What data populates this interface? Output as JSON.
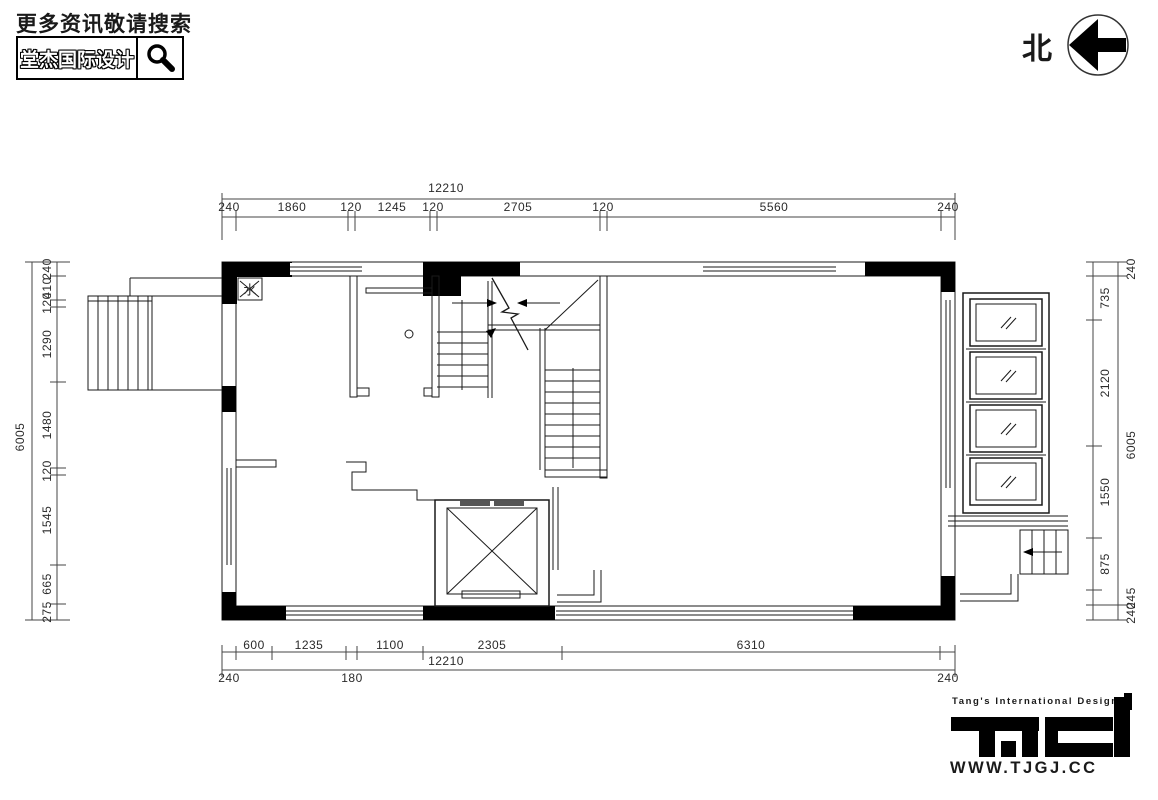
{
  "header": {
    "search_hint": "更多资讯敬请搜索",
    "brand": "堂杰国际设计"
  },
  "north": {
    "label": "北"
  },
  "plan": {
    "water_label": "水"
  },
  "dims": {
    "top": {
      "overall": "12210",
      "segments": [
        "240",
        "1860",
        "120",
        "1245",
        "120",
        "2705",
        "120",
        "5560",
        "240"
      ]
    },
    "bottom": {
      "segments": [
        "600",
        "1235",
        "1100",
        "2305",
        "6310"
      ],
      "overall": "12210",
      "below": [
        "240",
        "180",
        "240"
      ]
    },
    "left": {
      "overall": "6005",
      "segments": [
        "240",
        "410",
        "120",
        "1290",
        "1480",
        "120",
        "1545",
        "665",
        "275"
      ]
    },
    "right": {
      "inner": [
        "735",
        "2120",
        "1550",
        "875"
      ],
      "outer": [
        "240",
        "6005",
        "245",
        "240"
      ]
    }
  },
  "logo": {
    "tagline": "Tang's International Design",
    "url": "WWW.TJGJ.CC"
  },
  "colors": {
    "ink": "#1a1a1a"
  }
}
